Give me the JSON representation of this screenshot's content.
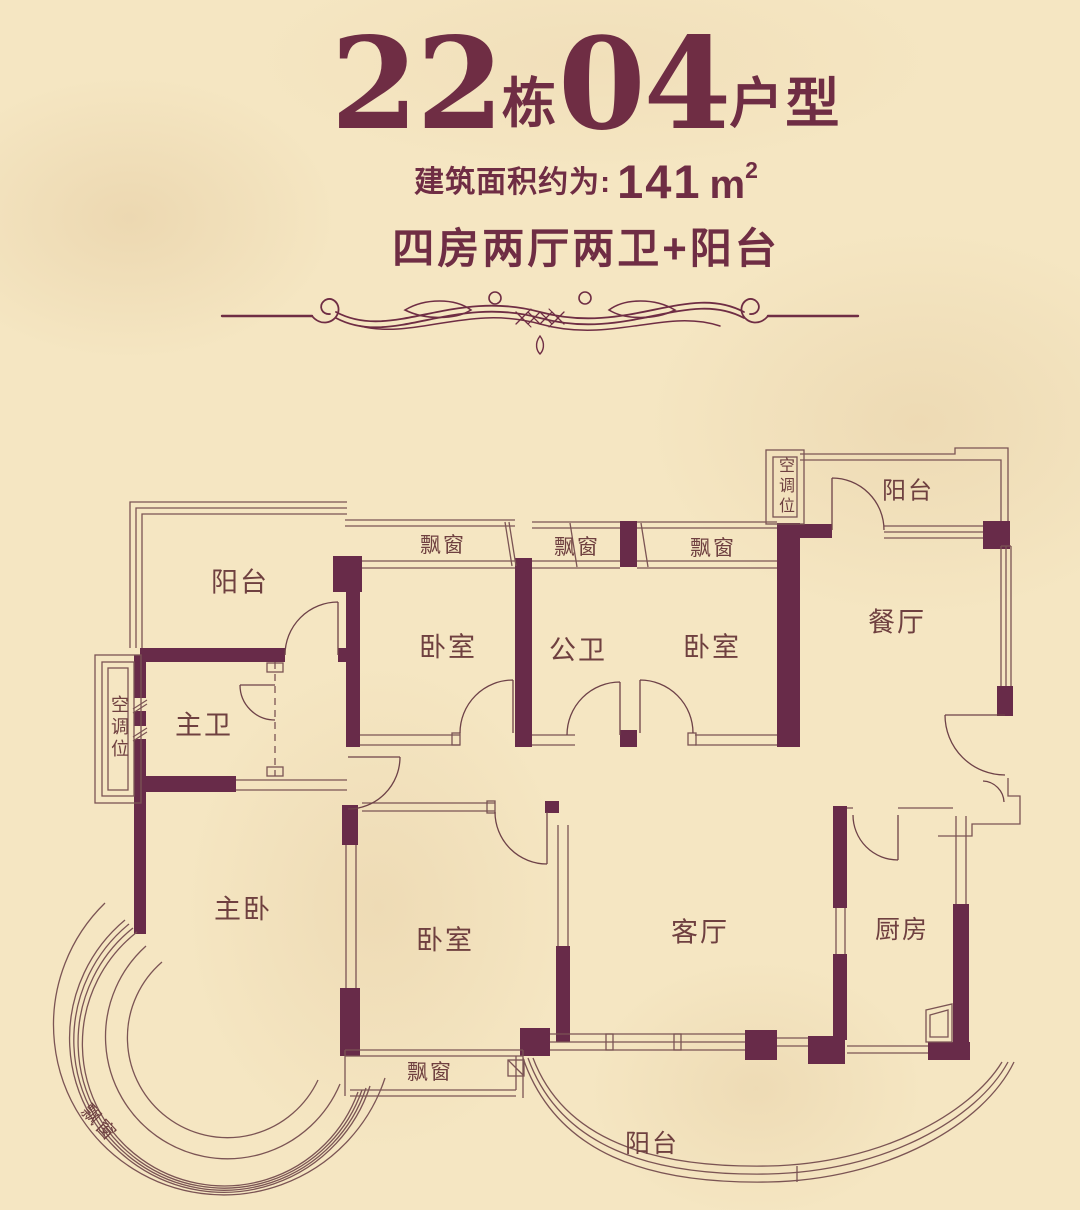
{
  "colors": {
    "background": "#f5e6c2",
    "wall": "#682b49",
    "thin_line": "#7b5454",
    "title_text": "#6f2d44",
    "room_label_text": "#6f4040"
  },
  "header": {
    "building_number": "22",
    "building_label": "栋",
    "unit_number": "04",
    "unit_label": "户型",
    "area_prefix": "建筑面积约为:",
    "area_number": "141",
    "area_unit": "m",
    "area_superscript": "2",
    "layout_description": "四房两厅两卫+阳台"
  },
  "plan": {
    "rooms": [
      {
        "id": "balcony-top-left",
        "label": "阳台"
      },
      {
        "id": "ac-unit-left",
        "label": "空调位"
      },
      {
        "id": "master-bathroom",
        "label": "主卫"
      },
      {
        "id": "master-bedroom",
        "label": "主卧"
      },
      {
        "id": "bay-window-top-1",
        "label": "飘窗"
      },
      {
        "id": "bedroom-1",
        "label": "卧室"
      },
      {
        "id": "bay-window-top-2",
        "label": "飘窗"
      },
      {
        "id": "public-bathroom",
        "label": "公卫"
      },
      {
        "id": "bay-window-top-3",
        "label": "飘窗"
      },
      {
        "id": "bedroom-2",
        "label": "卧室"
      },
      {
        "id": "ac-unit-top-right",
        "label": "空调位"
      },
      {
        "id": "balcony-top-right",
        "label": "阳台"
      },
      {
        "id": "dining-room",
        "label": "餐厅"
      },
      {
        "id": "bedroom-3",
        "label": "卧室"
      },
      {
        "id": "living-room",
        "label": "客厅"
      },
      {
        "id": "kitchen",
        "label": "厨房"
      },
      {
        "id": "bay-window-bottom",
        "label": "飘窗"
      },
      {
        "id": "bay-window-round",
        "label": "飘窗"
      },
      {
        "id": "balcony-bottom",
        "label": "阳台"
      }
    ]
  }
}
